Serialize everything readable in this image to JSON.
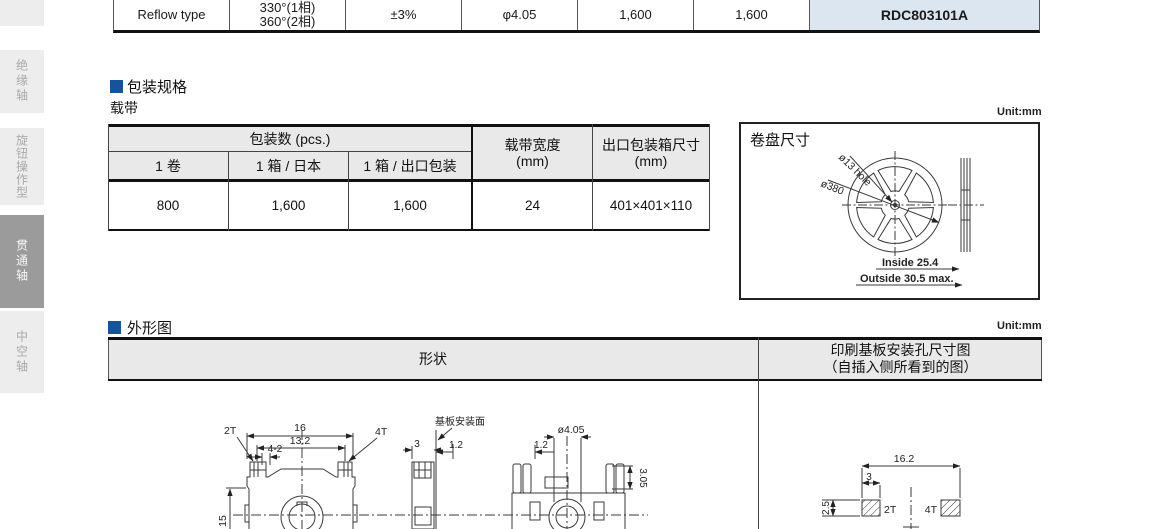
{
  "sidebar": {
    "tabs": [
      {
        "label": "绝缘轴",
        "active": false
      },
      {
        "label": "旋钮操作型",
        "active": false
      },
      {
        "label": "贯通轴",
        "active": true
      },
      {
        "label": "中空轴",
        "active": false
      }
    ]
  },
  "spec_table": {
    "row": {
      "type": "Reflow type",
      "rotation_line1": "330°(1相)",
      "rotation_line2": "360°(2相)",
      "tolerance": "±3%",
      "shaft": "φ4.05",
      "qty_japan": "1,600",
      "qty_export": "1,600",
      "part_number": "RDC803101A"
    }
  },
  "packaging": {
    "section_title": "包装规格",
    "subtitle": "载带",
    "unit": "Unit:mm",
    "table": {
      "group_header": "包装数 (pcs.)",
      "col_reel": "1 卷",
      "col_box_japan": "1 箱 / 日本",
      "col_box_export": "1 箱 / 出口包装",
      "col_tape_line1": "载带宽度",
      "col_tape_line2": "(mm)",
      "col_carton_line1": "出口包装箱尺寸",
      "col_carton_line2": "(mm)",
      "values": [
        "800",
        "1,600",
        "1,600",
        "24",
        "401×401×110"
      ]
    },
    "reel": {
      "title": "卷盘尺寸",
      "hole_label": "ø13 hole",
      "dia_label": "ø380",
      "inside_label": "Inside 25.4",
      "outside_label": "Outside 30.5 max."
    }
  },
  "outline": {
    "section_title": "外形图",
    "unit": "Unit:mm",
    "shape_header": "形状",
    "hole_header_line1": "印刷基板安装孔尺寸图",
    "hole_header_line2": "（自插入侧所看到的图）",
    "front": {
      "width": "16",
      "inner_width": "13.2",
      "slot": "4-2",
      "t2": "2T",
      "t4": "4T",
      "height": "15"
    },
    "side": {
      "mount_label": "基板安装面",
      "thickness": "3",
      "protrusion": "1.2"
    },
    "back": {
      "offset": "1.2",
      "shaft": "ø4.05",
      "depth": "3.05"
    },
    "pcb": {
      "width": "16.2",
      "pad_w": "3",
      "pad_h": "2.5",
      "t2": "2T",
      "t4": "4T"
    }
  },
  "colors": {
    "accent_blue": "#15549b",
    "part_cell_bg": "#dce6f1",
    "header_gray": "#e9e9e9",
    "sidebar_active": "#9b9b9b"
  }
}
